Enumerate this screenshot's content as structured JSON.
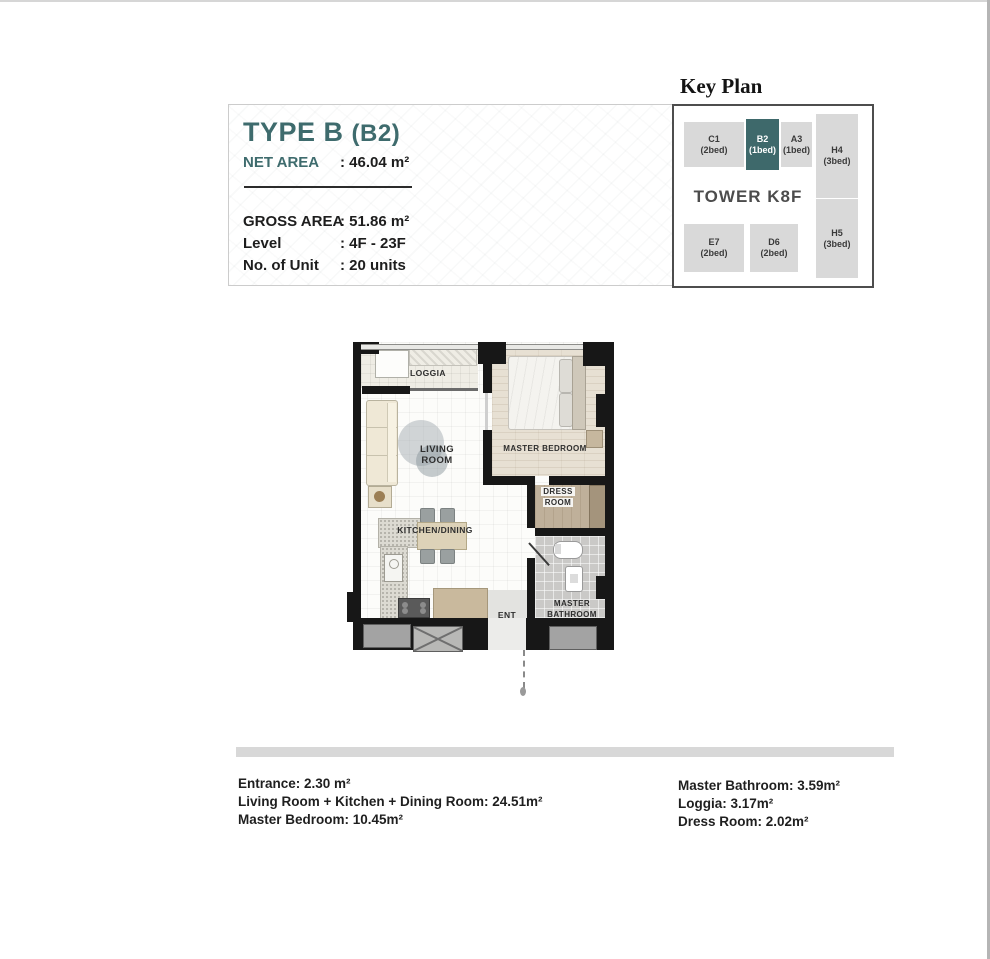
{
  "info_panel": {
    "type_title": "TYPE B",
    "type_variant": "(B2)",
    "net_area_label": "NET AREA",
    "net_area_value": ": 46.04 m²",
    "rows": [
      {
        "label": "GROSS AREA",
        "value": ": 51.86 m²"
      },
      {
        "label": "Level",
        "value": ": 4F - 23F"
      },
      {
        "label": "No. of Unit",
        "value": ": 20 units"
      }
    ],
    "accent_color": "#3E6B6D"
  },
  "key_plan": {
    "title": "Key Plan",
    "tower_label": "TOWER K8F",
    "highlight_color": "#3E696B",
    "cell_color": "#d9d9d9",
    "units": [
      {
        "code": "C1",
        "beds": "(2bed)"
      },
      {
        "code": "B2",
        "beds": "(1bed)"
      },
      {
        "code": "A3",
        "beds": "(1bed)"
      },
      {
        "code": "H4",
        "beds": "(3bed)"
      },
      {
        "code": "E7",
        "beds": "(2bed)"
      },
      {
        "code": "D6",
        "beds": "(2bed)"
      },
      {
        "code": "H5",
        "beds": "(3bed)"
      }
    ]
  },
  "floor_plan": {
    "labels": {
      "loggia": "LOGGIA",
      "living_room": [
        "LIVING",
        "ROOM"
      ],
      "master_bedroom": "MASTER BEDROOM",
      "dress_room": [
        "DRESS",
        "ROOM"
      ],
      "kitchen_dining": "KITCHEN/DINING",
      "entrance": "ENT",
      "master_bathroom": [
        "MASTER",
        "BATHROOM"
      ]
    }
  },
  "areas": {
    "left": [
      "Entrance: 2.30 m²",
      "Living Room + Kitchen + Dining Room: 24.51m²",
      "Master Bedroom: 10.45m²"
    ],
    "right": [
      "Master Bathroom: 3.59m²",
      "Loggia: 3.17m²",
      "Dress Room: 2.02m²"
    ]
  }
}
